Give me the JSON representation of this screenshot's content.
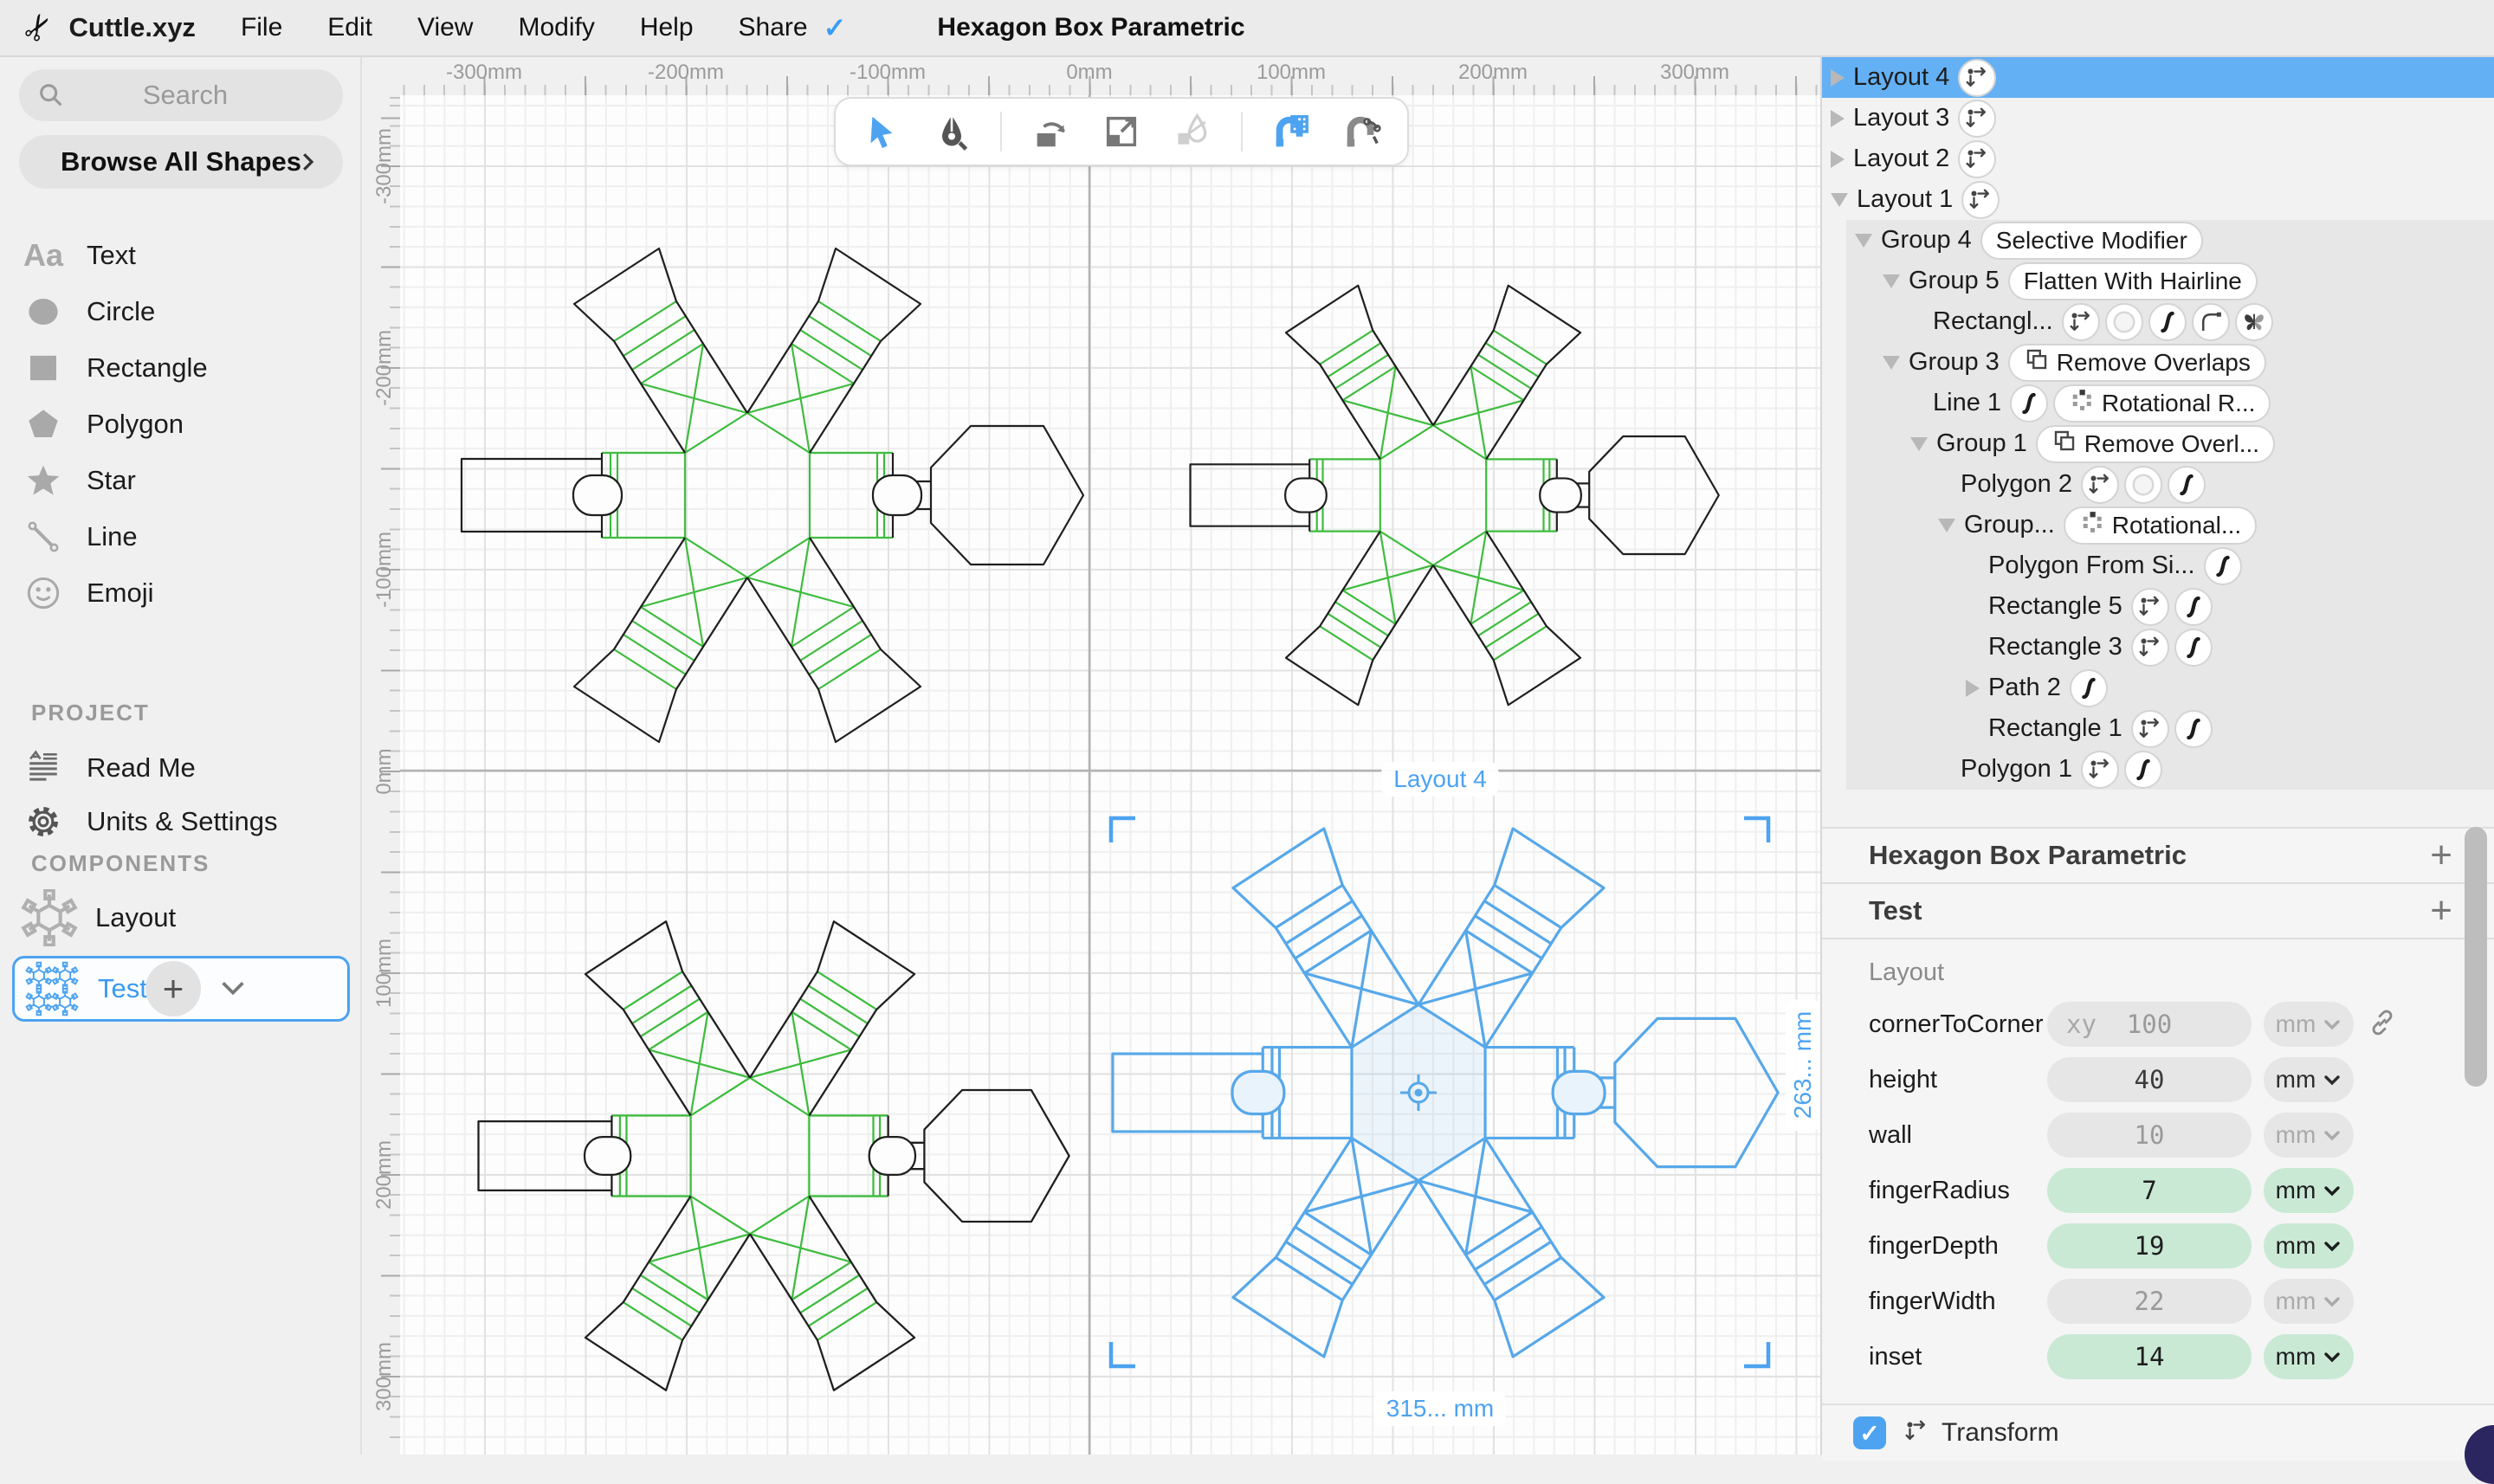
{
  "menu_bar": {
    "app_name": "Cuttle.xyz",
    "items": [
      "File",
      "Edit",
      "View",
      "Modify",
      "Help",
      "Share"
    ],
    "share_check": "✓",
    "title": "Hexagon Box Parametric"
  },
  "sidebar": {
    "search_placeholder": "Search",
    "browse_label": "Browse All Shapes",
    "shapes": [
      {
        "icon": "text-icon",
        "label": "Text"
      },
      {
        "icon": "circle-icon",
        "label": "Circle"
      },
      {
        "icon": "rectangle-icon",
        "label": "Rectangle"
      },
      {
        "icon": "polygon-icon",
        "label": "Polygon"
      },
      {
        "icon": "star-icon",
        "label": "Star"
      },
      {
        "icon": "line-icon",
        "label": "Line"
      },
      {
        "icon": "emoji-icon",
        "label": "Emoji"
      }
    ],
    "project_label": "PROJECT",
    "project_items": [
      {
        "icon": "readme-icon",
        "label": "Read Me"
      },
      {
        "icon": "gear-icon",
        "label": "Units & Settings"
      }
    ],
    "components_label": "COMPONENTS",
    "components": [
      {
        "icon": "net-thumb-gray",
        "label": "Layout",
        "selected": false
      },
      {
        "icon": "net-thumb-blue",
        "label": "Test",
        "selected": true
      }
    ]
  },
  "toolbar": {
    "tools": [
      {
        "name": "select-tool",
        "state": "active"
      },
      {
        "name": "pen-tool",
        "state": "normal"
      },
      {
        "name": "separator",
        "state": ""
      },
      {
        "name": "rotate-tool",
        "state": "normal"
      },
      {
        "name": "scale-tool",
        "state": "normal"
      },
      {
        "name": "transform-pen-tool",
        "state": "disabled"
      },
      {
        "name": "separator",
        "state": ""
      },
      {
        "name": "snap-grid-tool",
        "state": "active"
      },
      {
        "name": "snap-point-tool",
        "state": "normal"
      }
    ]
  },
  "canvas": {
    "ruler_top": [
      "-300mm",
      "-200mm",
      "-100mm",
      "0mm",
      "100mm",
      "200mm",
      "300mm"
    ],
    "ruler_left": [
      "-300mm",
      "-200mm",
      "-100mm",
      "0mm",
      "100mm",
      "200mm",
      "300mm"
    ],
    "selected_label": "Layout 4",
    "width_label": "315... mm",
    "height_label": "263... mm"
  },
  "layers": [
    {
      "name": "Layout 4",
      "depth": 0,
      "arrow": "collapsed",
      "icons": [
        "move-icon"
      ],
      "selected": true
    },
    {
      "name": "Layout 3",
      "depth": 0,
      "arrow": "collapsed",
      "icons": [
        "move-icon"
      ],
      "selected": false
    },
    {
      "name": "Layout 2",
      "depth": 0,
      "arrow": "collapsed",
      "icons": [
        "move-icon"
      ],
      "selected": false
    },
    {
      "name": "Layout 1",
      "depth": 0,
      "arrow": "expanded",
      "icons": [
        "move-icon"
      ],
      "selected": false
    },
    {
      "name": "Group 4",
      "depth": 1,
      "arrow": "expanded",
      "modifier": {
        "label": "Selective Modifier"
      }
    },
    {
      "name": "Group 5",
      "depth": 2,
      "arrow": "expanded",
      "modifier": {
        "label": "Flatten With Hairline"
      }
    },
    {
      "name": "Rectangl...",
      "depth": 3,
      "arrow": "none",
      "icons": [
        "move-icon",
        "fill-icon",
        "stroke-icon",
        "corner-icon",
        "butterfly-icon"
      ]
    },
    {
      "name": "Group 3",
      "depth": 2,
      "arrow": "expanded",
      "modifier": {
        "icon": "overlap-icon",
        "label": "Remove Overlaps"
      }
    },
    {
      "name": "Line 1",
      "depth": 3,
      "arrow": "none",
      "icons": [
        "stroke-icon"
      ],
      "modifier": {
        "icon": "rotational-icon",
        "label": "Rotational R..."
      }
    },
    {
      "name": "Group 1",
      "depth": 3,
      "arrow": "expanded",
      "modifier": {
        "icon": "overlap-icon",
        "label": "Remove Overl..."
      }
    },
    {
      "name": "Polygon 2",
      "depth": 4,
      "arrow": "none",
      "icons": [
        "move-icon",
        "fill-icon",
        "stroke-icon"
      ]
    },
    {
      "name": "Group...",
      "depth": 4,
      "arrow": "expanded",
      "modifier": {
        "icon": "rotational-icon",
        "label": "Rotational..."
      }
    },
    {
      "name": "Polygon From Si...",
      "depth": 5,
      "arrow": "none",
      "icons": [
        "stroke-icon"
      ]
    },
    {
      "name": "Rectangle 5",
      "depth": 5,
      "arrow": "none",
      "icons": [
        "move-icon",
        "stroke-icon"
      ]
    },
    {
      "name": "Rectangle 3",
      "depth": 5,
      "arrow": "none",
      "icons": [
        "move-icon",
        "stroke-icon"
      ]
    },
    {
      "name": "Path 2",
      "depth": 5,
      "arrow": "collapsed",
      "icons": [
        "stroke-icon"
      ]
    },
    {
      "name": "Rectangle 1",
      "depth": 5,
      "arrow": "none",
      "icons": [
        "move-icon",
        "stroke-icon"
      ]
    },
    {
      "name": "Polygon 1",
      "depth": 4,
      "arrow": "none",
      "icons": [
        "move-icon",
        "stroke-icon"
      ]
    }
  ],
  "properties": {
    "sections": [
      {
        "name": "Hexagon Box Parametric",
        "add": "+"
      },
      {
        "name": "Test",
        "add": "+"
      }
    ],
    "group_label": "Layout",
    "params": [
      {
        "name": "cornerToCorner",
        "prefix": "xy",
        "value": "100",
        "unit": "mm",
        "style": "muted",
        "link": true
      },
      {
        "name": "height",
        "value": "40",
        "unit": "mm",
        "style": "set",
        "link": false
      },
      {
        "name": "wall",
        "value": "10",
        "unit": "mm",
        "style": "muted",
        "link": false
      },
      {
        "name": "fingerRadius",
        "value": "7",
        "unit": "mm",
        "style": "green",
        "link": false
      },
      {
        "name": "fingerDepth",
        "value": "19",
        "unit": "mm",
        "style": "green",
        "link": false
      },
      {
        "name": "fingerWidth",
        "value": "22",
        "unit": "mm",
        "style": "muted",
        "link": false
      },
      {
        "name": "inset",
        "value": "14",
        "unit": "mm",
        "style": "green",
        "link": false
      }
    ],
    "transform": {
      "label": "Transform",
      "checked": true
    }
  },
  "colors": {
    "accent_blue": "#4da3f0",
    "selection_row_blue": "#64b0f4",
    "shape_blue": "#57a8e9",
    "fold_green": "#3fbc3f",
    "cut_black": "#1f1f1f",
    "param_green_bg": "#c9e9d4"
  }
}
